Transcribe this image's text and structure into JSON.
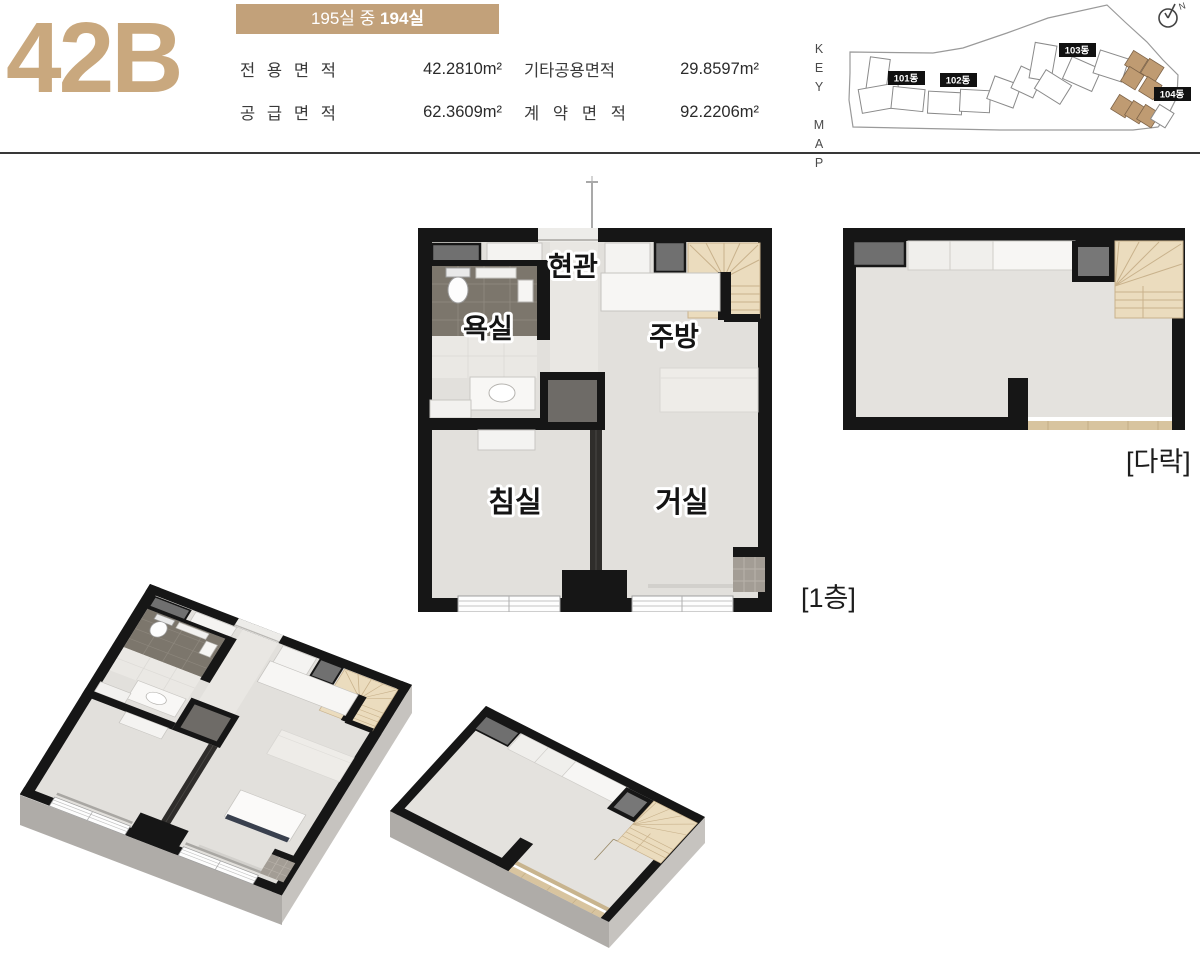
{
  "header": {
    "unit_code": "42B",
    "badge": {
      "prefix": "195실 중 ",
      "bold": "194실"
    },
    "areas": [
      {
        "label": "전 용 면 적",
        "value": "42.2810m²"
      },
      {
        "label": "기타공용면적",
        "value": "29.8597m²"
      },
      {
        "label": "공 급 면 적",
        "value": "62.3609m²"
      },
      {
        "label": "계 약 면 적",
        "value": "92.2206m²"
      }
    ],
    "keymap": {
      "title": "KEY MAP",
      "compass": "N",
      "buildings": [
        {
          "label": "101동"
        },
        {
          "label": "102동"
        },
        {
          "label": "103동"
        },
        {
          "label": "104동",
          "highlighted": true
        }
      ]
    }
  },
  "floorplan": {
    "rooms": {
      "entrance": "현관",
      "bathroom": "욕실",
      "kitchen": "주방",
      "bedroom": "침실",
      "living": "거실"
    },
    "captions": {
      "floor1": "[1층]",
      "attic": "[다락]"
    }
  },
  "colors": {
    "accent": "#C2A17A",
    "wall": "#161616",
    "floor": "#E2E0DC",
    "stair_wood": "#EBDCBE"
  }
}
